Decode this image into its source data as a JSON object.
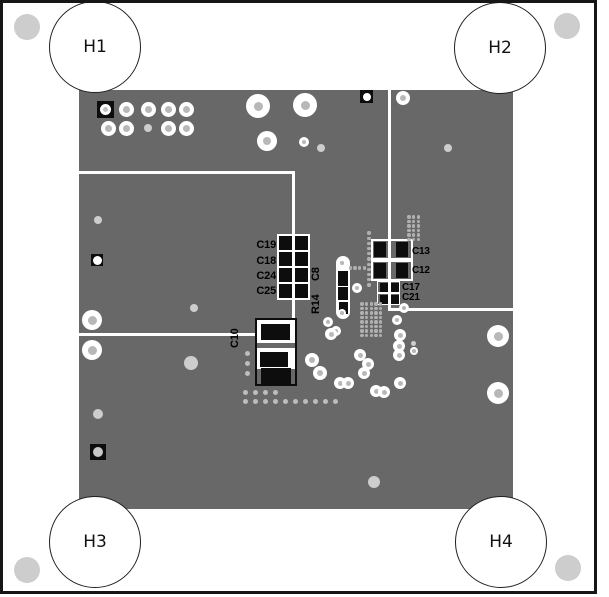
{
  "board": {
    "mounting_holes": [
      {
        "label": "H1"
      },
      {
        "label": "H2"
      },
      {
        "label": "H3"
      },
      {
        "label": "H4"
      }
    ],
    "components": {
      "left_capacitor_bank": [
        "C19",
        "C18",
        "C24",
        "C25"
      ],
      "right_capacitors": [
        "C13",
        "C12",
        "C17",
        "C21"
      ],
      "vertical_labels": {
        "c8": "C8",
        "r14": "R14",
        "c10": "C10"
      }
    }
  },
  "colors": {
    "board": "#686868",
    "frame": "#161616",
    "pad_black": "#0d0d0d",
    "silk_white": "#ffffff",
    "label_black": "#000000",
    "via_center": "#b8b8b8",
    "dot": "#cdcdcd",
    "grid_dot": "#b0b0b0"
  },
  "graphics": {
    "vias": [
      [
        126,
        109,
        7.5,
        3.5
      ],
      [
        148,
        109,
        7.5,
        3.5
      ],
      [
        168,
        109,
        7.5,
        3.5
      ],
      [
        186,
        109,
        7.5,
        3.5
      ],
      [
        108,
        128,
        7.5,
        3.5
      ],
      [
        126,
        128,
        7.5,
        3.5
      ],
      [
        168,
        128,
        7.5,
        3.5
      ],
      [
        186,
        128,
        7.5,
        3.5
      ],
      [
        258,
        106,
        12,
        4.5
      ],
      [
        305,
        105,
        12,
        4.5
      ],
      [
        267,
        141,
        10,
        4
      ],
      [
        304,
        142,
        5,
        2
      ],
      [
        403,
        98,
        7,
        3
      ],
      [
        92,
        320,
        10,
        4.5
      ],
      [
        92,
        350,
        10,
        4.5
      ],
      [
        498,
        336,
        11,
        4.5
      ],
      [
        498,
        393,
        11,
        4.5
      ],
      [
        342,
        263,
        4,
        1.8
      ],
      [
        342,
        313,
        4,
        1.8
      ],
      [
        328,
        322,
        5,
        2
      ],
      [
        336,
        331,
        5,
        2
      ],
      [
        357,
        288,
        5,
        2
      ],
      [
        404,
        308,
        5,
        2
      ],
      [
        397,
        320,
        5,
        2
      ],
      [
        414,
        351,
        4,
        1.8
      ],
      [
        331,
        334,
        6,
        2.5
      ],
      [
        400,
        335,
        6,
        2.5
      ],
      [
        399,
        346,
        6,
        2.5
      ],
      [
        399,
        355,
        6,
        2.5
      ],
      [
        312,
        360,
        7,
        3
      ],
      [
        360,
        355,
        6,
        2.5
      ],
      [
        368,
        364,
        6,
        2.5
      ],
      [
        320,
        373,
        7,
        3
      ],
      [
        364,
        373,
        6,
        2.5
      ],
      [
        340,
        383,
        6,
        2.5
      ],
      [
        348,
        383,
        6,
        2.5
      ],
      [
        400,
        383,
        6,
        2.5
      ],
      [
        376,
        391,
        6,
        2.5
      ],
      [
        384,
        392,
        6,
        2.5
      ]
    ],
    "dots": [
      [
        27,
        27,
        13
      ],
      [
        567,
        26,
        13
      ],
      [
        27,
        570,
        13
      ],
      [
        568,
        568,
        13
      ],
      [
        148,
        128,
        4
      ],
      [
        98,
        220,
        4
      ],
      [
        98,
        414,
        5
      ],
      [
        194,
        308,
        4
      ],
      [
        191,
        363,
        7
      ],
      [
        321,
        148,
        4
      ],
      [
        448,
        148,
        4
      ],
      [
        374,
        482,
        6
      ],
      [
        413,
        343,
        2.5
      ]
    ],
    "dot_grids": [
      {
        "x0": 245,
        "y0": 392,
        "cols": 4,
        "rows": 1,
        "dx": 10,
        "dy": 0,
        "r": 2.5,
        "color": "#bdbdbd"
      },
      {
        "x0": 245,
        "y0": 401,
        "cols": 10,
        "rows": 1,
        "dx": 10.1,
        "dy": 0,
        "r": 2.5,
        "color": "#bdbdbd"
      },
      {
        "x0": 247,
        "y0": 353,
        "cols": 1,
        "rows": 3,
        "dx": 0,
        "dy": 10,
        "r": 2.5,
        "color": "#bdbdbd"
      },
      {
        "x0": 409,
        "y0": 217,
        "cols": 3,
        "rows": 6,
        "dx": 4.7,
        "dy": 4.5,
        "r": 1.7,
        "color": "#b0b0b0"
      },
      {
        "x0": 369,
        "y0": 233,
        "cols": 1,
        "rows": 11,
        "dx": 0,
        "dy": 5.2,
        "r": 1.7,
        "color": "#b0b0b0"
      },
      {
        "x0": 350.5,
        "y0": 268,
        "cols": 4,
        "rows": 1,
        "dx": 4.6,
        "dy": 0,
        "r": 1.7,
        "color": "#b0b0b0"
      },
      {
        "x0": 362,
        "y0": 304,
        "cols": 5,
        "rows": 8,
        "dx": 4.7,
        "dy": 4.5,
        "r": 1.7,
        "color": "#b0b0b0"
      }
    ]
  }
}
